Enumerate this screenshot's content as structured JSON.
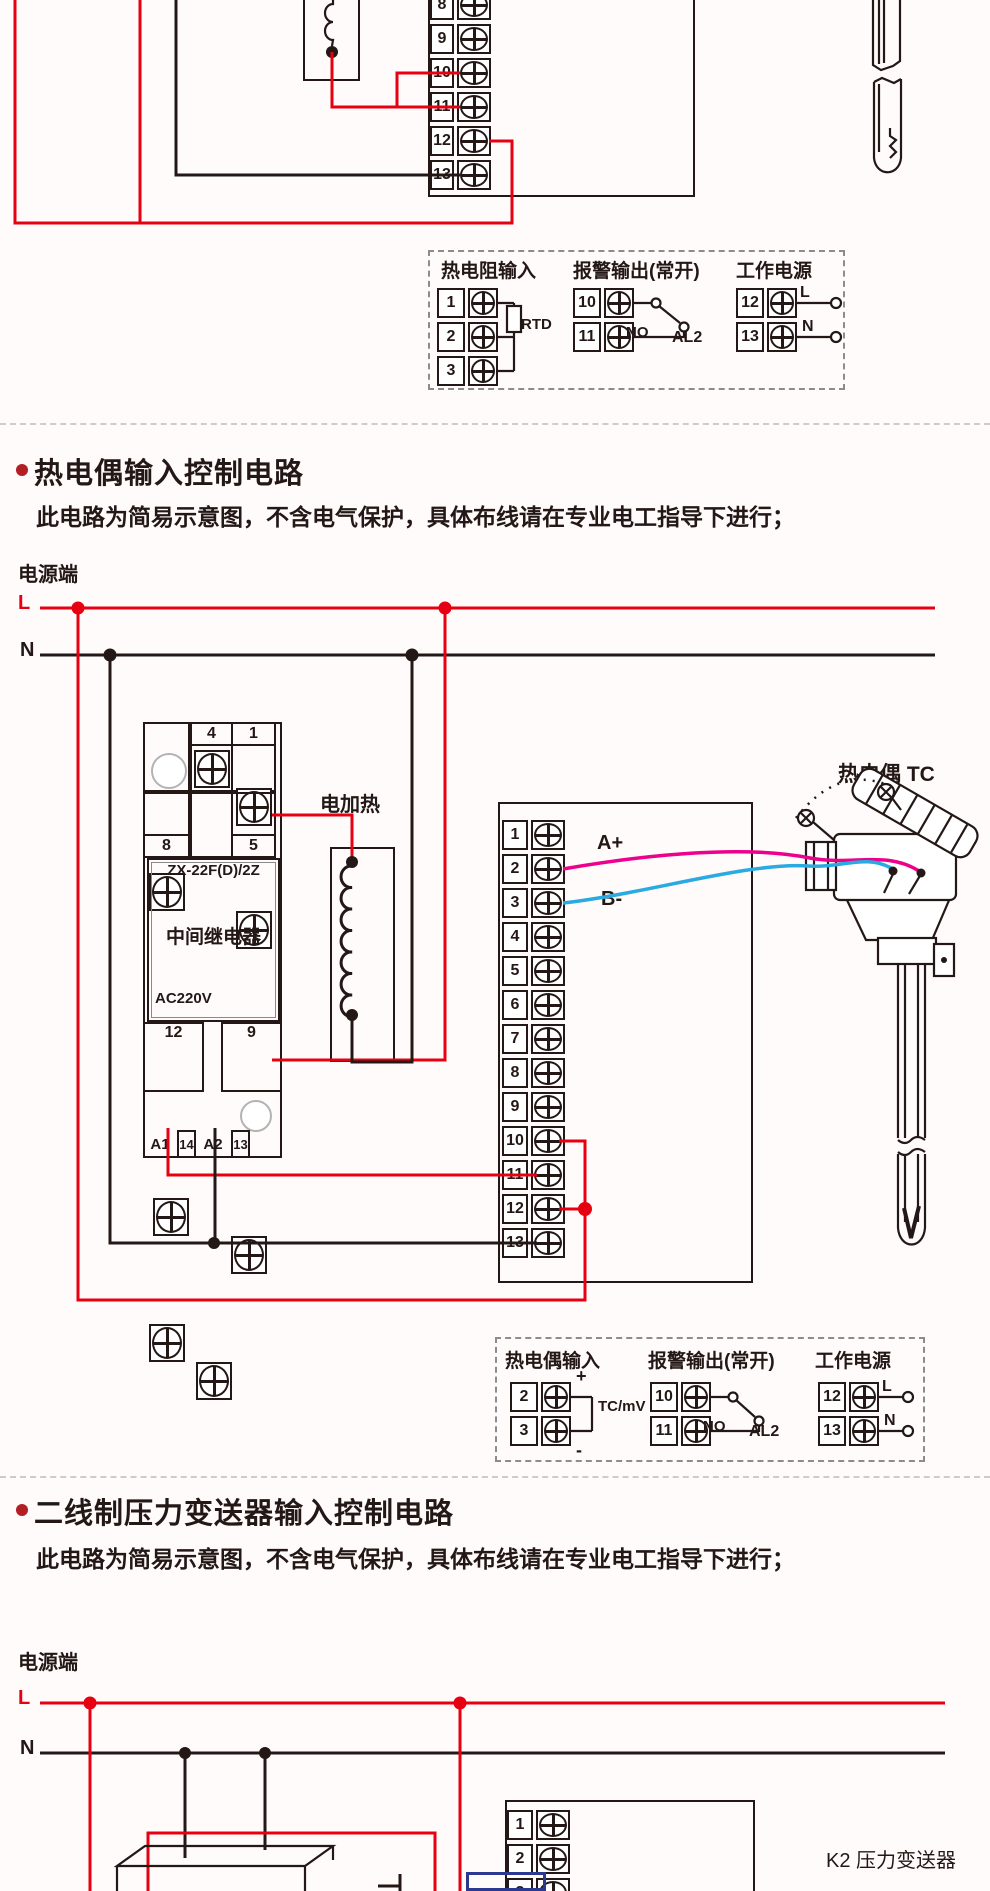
{
  "colors": {
    "red": "#e60012",
    "ink": "#231815",
    "magenta": "#ec008c",
    "cyan": "#29abe2",
    "highlight_blue": "#2b3990",
    "bullet": "#b21e23",
    "divider": "#cccccc",
    "legend_dash": "#8c8c8c",
    "bg": "#fffbfb"
  },
  "rtd_diagram": {
    "strip_terminals": [
      "8",
      "9",
      "10",
      "11",
      "12",
      "13"
    ],
    "legend": {
      "input": {
        "title": "热电阻输入",
        "terminals": [
          "1",
          "2",
          "3"
        ],
        "device_label": "RTD"
      },
      "alarm": {
        "title": "报警输出(常开)",
        "terminals": [
          "10",
          "11"
        ],
        "contact_label": "NO",
        "output_label": "AL2"
      },
      "power": {
        "title": "工作电源",
        "terminals": [
          "12",
          "13"
        ],
        "live_label": "L",
        "neutral_label": "N"
      }
    }
  },
  "tc_diagram": {
    "heading": "热电偶输入控制电路",
    "subtitle": "此电路为简易示意图，不含电气保护，具体布线请在专业电工指导下进行；",
    "power_source_label": "电源端",
    "live_label": "L",
    "neutral_label": "N",
    "relay": {
      "model": "ZX-22F(D)/2Z",
      "name": "中间继电器",
      "voltage": "AC220V",
      "top_terminals": [
        "4",
        "1"
      ],
      "mid_terminals": [
        "8",
        "5"
      ],
      "out_terminals": [
        "12",
        "9"
      ],
      "coil_labels": [
        "A1",
        "14",
        "A2",
        "13"
      ]
    },
    "heater_label": "电加热",
    "strip_terminals": [
      "1",
      "2",
      "3",
      "4",
      "5",
      "6",
      "7",
      "8",
      "9",
      "10",
      "11",
      "12",
      "13"
    ],
    "wire_positive": "A+",
    "wire_negative": "B-",
    "sensor_label": "热电偶 TC",
    "legend": {
      "input": {
        "title": "热电偶输入",
        "terminals": [
          "2",
          "3"
        ],
        "plus": "+",
        "minus": "-",
        "device_label": "TC/mV"
      },
      "alarm": {
        "title": "报警输出(常开)",
        "terminals": [
          "10",
          "11"
        ],
        "contact_label": "NO",
        "output_label": "AL2"
      },
      "power": {
        "title": "工作电源",
        "terminals": [
          "12",
          "13"
        ],
        "live_label": "L",
        "neutral_label": "N"
      }
    }
  },
  "pressure_diagram": {
    "heading": "二线制压力变送器输入控制电路",
    "subtitle": "此电路为简易示意图，不含电气保护，具体布线请在专业电工指导下进行；",
    "power_source_label": "电源端",
    "live_label": "L",
    "neutral_label": "N",
    "strip_terminals": [
      "1",
      "2",
      "3"
    ],
    "device_label": "K2  压力变送器"
  }
}
